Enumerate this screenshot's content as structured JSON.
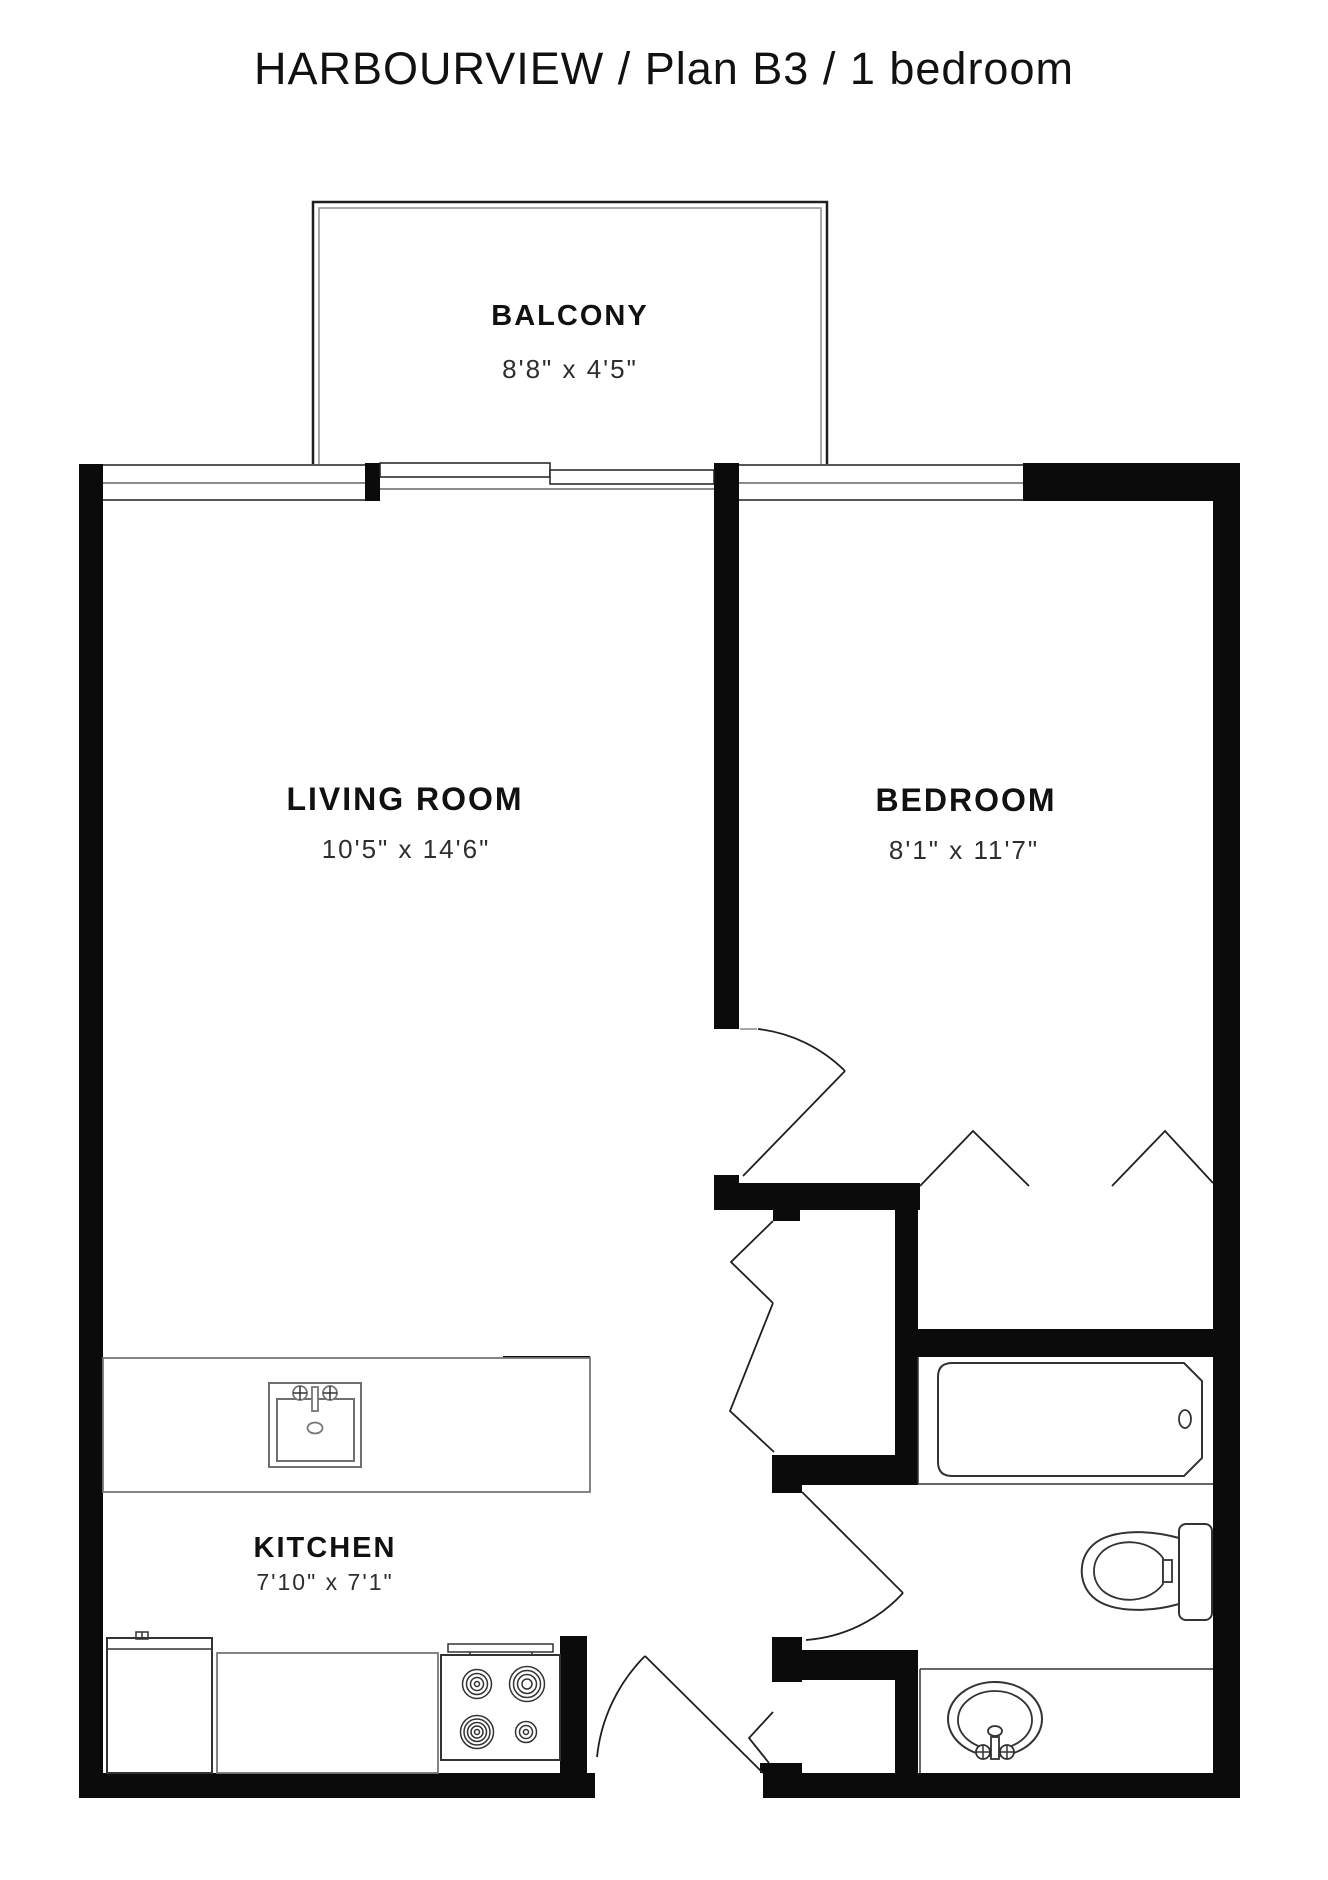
{
  "title": "HARBOURVIEW / Plan B3 / 1 bedroom",
  "rooms": {
    "balcony": {
      "name": "BALCONY",
      "dimensions": "8'8\" x 4'5\""
    },
    "living_room": {
      "name": "LIVING ROOM",
      "dimensions": "10'5\" x 14'6\""
    },
    "bedroom": {
      "name": "BEDROOM",
      "dimensions": "8'1\" x 11'7\""
    },
    "kitchen": {
      "name": "KITCHEN",
      "dimensions": "7'10\" x 7'1\""
    }
  },
  "fixtures": {
    "kitchen": [
      "kitchen-sink-icon",
      "refrigerator-icon",
      "kitchen-counter-icon",
      "stove-icon",
      "island-counter-icon"
    ],
    "bathroom": [
      "bathtub-icon",
      "toilet-icon",
      "bathroom-sink-icon",
      "vanity-counter-icon"
    ],
    "doors": [
      "entry-door-icon",
      "bedroom-door-icon",
      "bathroom-door-icon",
      "hall-closet-bifold-icon",
      "bedroom-closet-bifold-icon",
      "balcony-sliding-door-icon"
    ],
    "windows": [
      "living-room-window-icon",
      "bedroom-window-icon"
    ]
  },
  "colors": {
    "wall": "#0b0b0b",
    "line": "#1f1f1f",
    "muted_line": "#8c8c8c",
    "fixture": "#333333",
    "background": "#ffffff",
    "text": "#111111",
    "dim_text": "#2e2e2e"
  }
}
